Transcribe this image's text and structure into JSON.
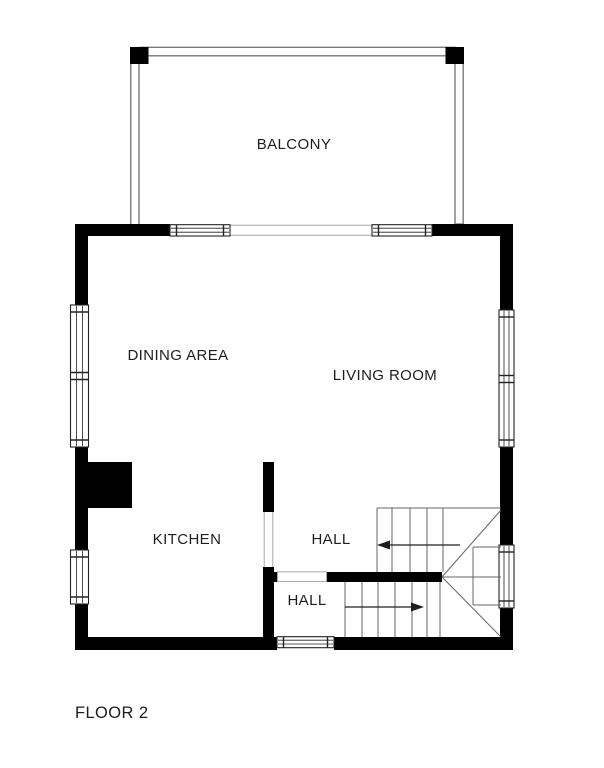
{
  "title": "FLOOR 2",
  "rooms": {
    "balcony": "BALCONY",
    "dining_area": "DINING AREA",
    "living_room": "LIVING ROOM",
    "kitchen": "KITCHEN",
    "hall_upper": "HALL",
    "hall_lower": "HALL"
  },
  "stairs": {
    "upper_flight_arrow_direction": "left",
    "lower_flight_arrow_direction": "right"
  },
  "colors": {
    "background": "#ffffff",
    "wall": "#000000",
    "window_outline": "#222222",
    "stair_line": "#666666",
    "railing_line": "#7a7a7a",
    "opening_line": "#a8a8a8",
    "text": "#1d1d1d"
  }
}
